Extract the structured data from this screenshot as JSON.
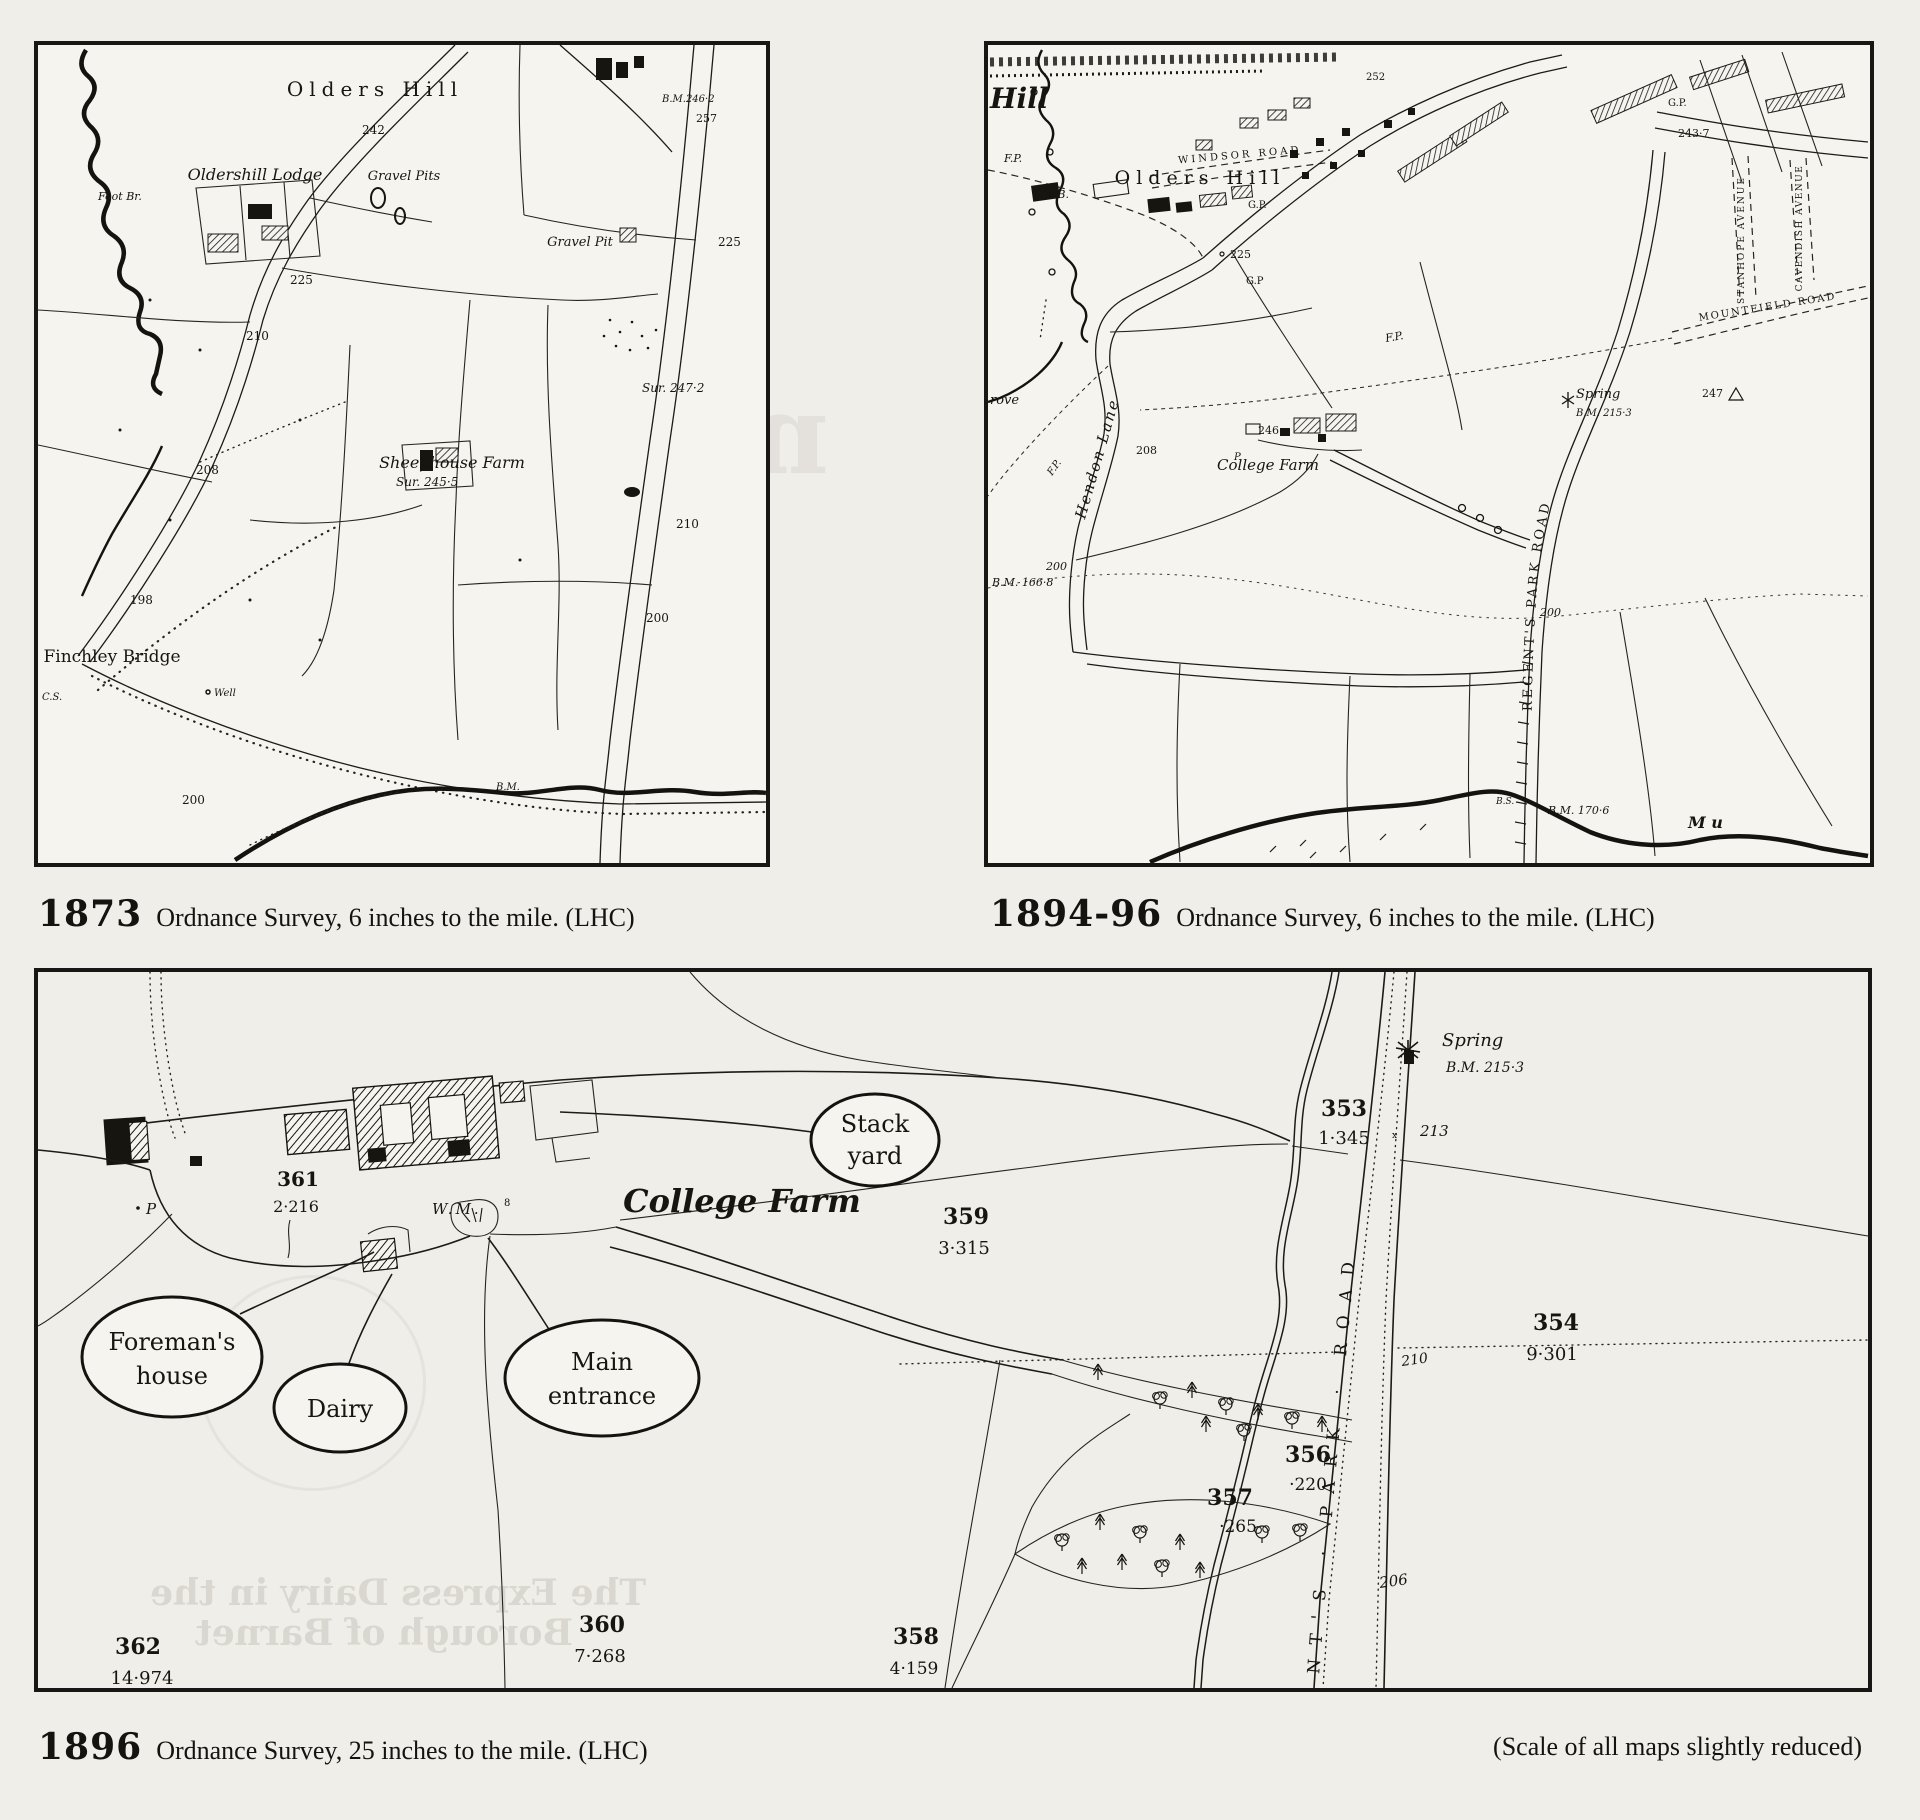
{
  "page": {
    "background": "#f0eee9",
    "paper": "#f6f4ef",
    "ink": "#1c1b18"
  },
  "captions": {
    "map1": {
      "year": "1873",
      "text": "Ordnance Survey,  6 inches to the mile.  (LHC)"
    },
    "map2": {
      "year": "1894-96",
      "text": "Ordnance Survey,  6 inches to the mile.  (LHC)"
    },
    "map3": {
      "year": "1896",
      "text": "Ordnance Survey,  25 inches to the mile.  (LHC)"
    },
    "note": "(Scale of all maps slightly reduced)"
  },
  "map1873": {
    "labels": {
      "olders_hill": "Olders Hill",
      "bm246": "B.M.246·2",
      "e257": "257",
      "e242": "242",
      "lodge": "Oldershill Lodge",
      "gravel_pits": "Gravel Pits",
      "gravel_pit": "Gravel Pit",
      "foot_br": "Foot Br.",
      "e225a": "225",
      "e225b": "225",
      "e210a": "210",
      "e210b": "210",
      "e208": "208",
      "e198": "198",
      "e200a": "200",
      "e200b": "200",
      "sheephouse": "Sheephouse Farm",
      "sur245": "Sur. 245·5",
      "sur247": "Sur. 247·2",
      "finchley": "Finchley Bridge",
      "well": "Well",
      "bm_low": "B.M.",
      "cs": "C.S."
    }
  },
  "map1894": {
    "labels": {
      "hill": "Hill",
      "fp1": "F.P.",
      "fb": "F.B.",
      "fp2": "F.P.",
      "fp3": "F.P.",
      "windsor": "WINDSOR ROAD",
      "olders_hill": "Olders Hill",
      "gp1": "G.P.",
      "gp2": "G.P",
      "gp3": "G.P.",
      "e225": "225",
      "e252": "252",
      "e2437": "243·7",
      "stanhope": "STANHOPE AVENUE",
      "cavendish": "CAVENDISH AVENUE",
      "mountfield": "MOUNTFIELD ROAD",
      "regents": "REGENT'S PARK ROAD",
      "spring": "Spring",
      "bm215": "B.M. 215·3",
      "e247": "247",
      "hendon": "Hendon Lane",
      "grove": "rove",
      "e208": "208",
      "e246": "246",
      "p": "P",
      "college": "College Farm",
      "bm166": "B.M. 166·8",
      "e200a": "200",
      "e200b": "200",
      "bs": "B.S.",
      "bm170": "B.M. 170·6",
      "mu": "M u"
    }
  },
  "map1896": {
    "labels": {
      "spring": "Spring",
      "bm215": "B.M. 215·3",
      "p353": "353",
      "a353": "1·345",
      "e213": "213",
      "p354": "354",
      "a354": "9·301",
      "e210": "210",
      "p356": "356",
      "a356": "·220",
      "p357": "357",
      "a357": "·265",
      "e206": "206",
      "p358": "358",
      "a358": "4·159",
      "p359": "359",
      "a359": "3·315",
      "p360": "360",
      "a360": "7·268",
      "p361": "361",
      "a361": "2·216",
      "p362": "362",
      "a362": "14·974",
      "college": "College Farm",
      "wm": "W.M.",
      "wm8": "8",
      "p": "P",
      "road": "NT'S · PARK · ROAD"
    },
    "callouts": {
      "stack1": "Stack",
      "stack2": "yard",
      "foreman1": "Foreman's",
      "foreman2": "house",
      "dairy": "Dairy",
      "main1": "Main",
      "main2": "entrance"
    }
  },
  "bleedthrough": {
    "map1_l1": "Milk for",
    "map1_l2": "the",
    "map1_l3": "millions",
    "map1_l4": "Grafton",
    "map3_l1": "The Express Dairy in the",
    "map3_l2": "Borough of Barnet"
  }
}
